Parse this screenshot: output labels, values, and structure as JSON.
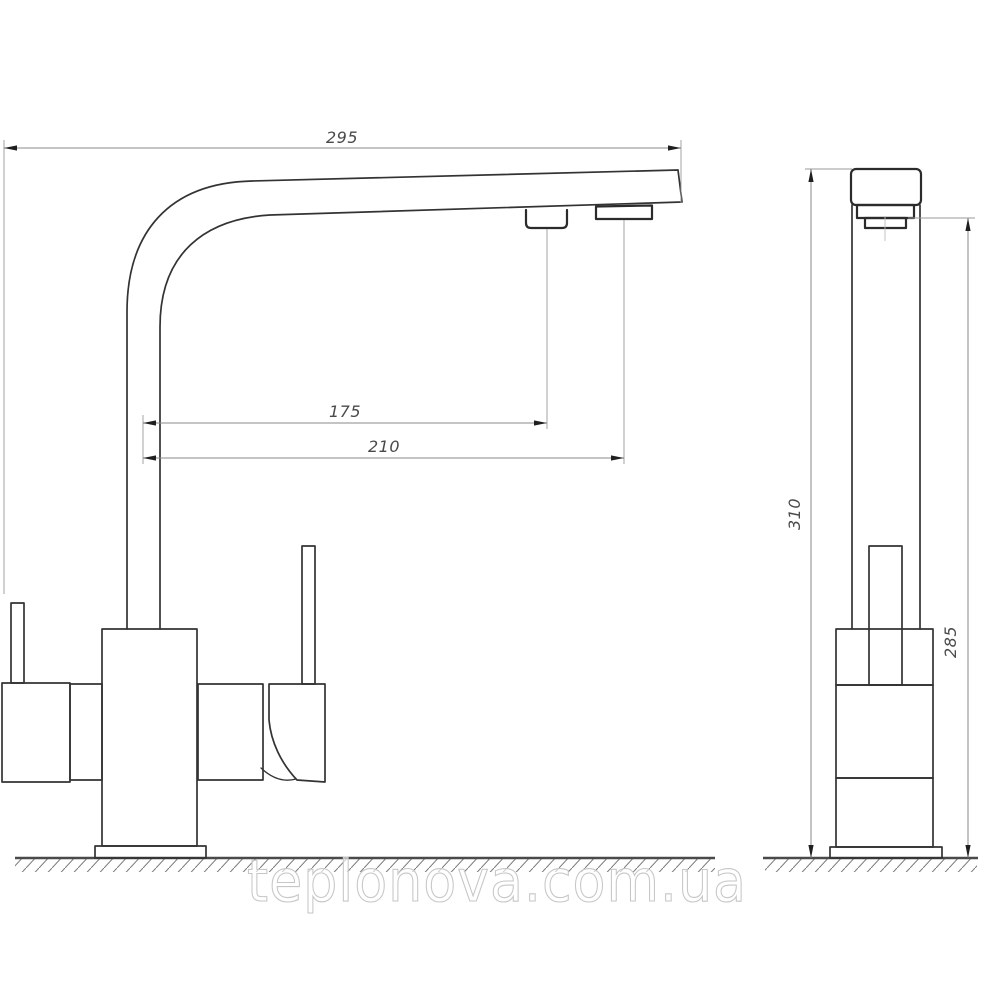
{
  "drawing": {
    "subject": "kitchen-faucet-two-view-technical-drawing",
    "views": {
      "front": {
        "name": "front-view"
      },
      "side": {
        "name": "side-view"
      }
    },
    "dimensions": {
      "spout_reach": "295",
      "filtered_outlet_offset": "175",
      "main_outlet_offset": "210",
      "overall_height": "310",
      "outlet_height": "285"
    },
    "watermark": {
      "text": "teplonova.com.ua"
    },
    "colors": {
      "object_line": "#333333",
      "dimension_line": "#8a8a8a",
      "arrow": "#1f1f1f",
      "dimension_text": "#4a4a4a",
      "ground_line": "#4a4a4a",
      "hatch": "#7a7a7a",
      "watermark_outline": "#c6c6c6",
      "background": "#ffffff"
    }
  }
}
